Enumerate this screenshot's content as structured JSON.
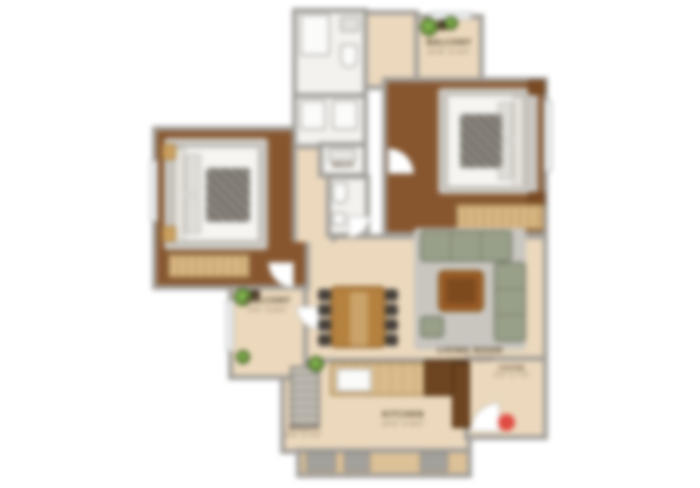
{
  "plan": {
    "type": "apartment-floor-plan",
    "rooms": {
      "balcony_top": {
        "name": "BALCONY",
        "size": "10'6\" X 4'0\""
      },
      "balcony_left": {
        "name": "BALCONY",
        "size": "4'0\" X 8'6\""
      },
      "living": {
        "name": "LIVING ROOM",
        "size": "16'5\" X 11'0\""
      },
      "kitchen": {
        "name": "KITCHEN",
        "size": "10'0\" X 8'0\""
      },
      "utility": {
        "name": "UTILITY",
        "size": "6'0\" X 3'0\""
      },
      "foyer": {
        "name": "FOYER",
        "size": "5'0\" X 7'0\""
      },
      "wash": {
        "name": "WASH"
      }
    },
    "colors": {
      "wall": "#a19e99",
      "wood_floor": "#87562f",
      "light_floor": "#ecd9bd",
      "tile_floor": "#f3f2ef",
      "wardrobe": "#d9b784",
      "sofa": "#99a089",
      "plant": "#6da23c",
      "entry_marker": "#e04b42"
    }
  }
}
